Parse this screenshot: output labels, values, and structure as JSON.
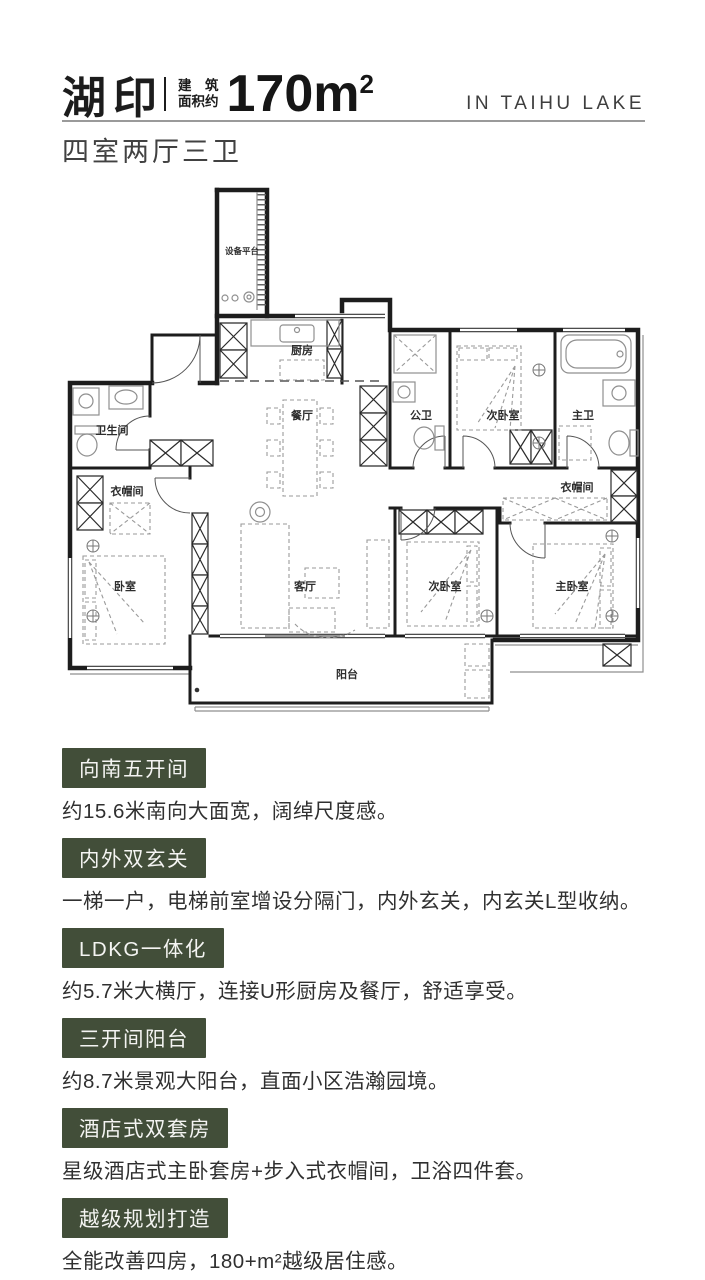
{
  "header": {
    "logo": "湖印",
    "area_label_line1": "建　筑",
    "area_label_line2": "面积约",
    "area_value": "170m",
    "area_sup": "2",
    "tagline": "IN TAIHU LAKE",
    "subtitle": "四室两厅三卫"
  },
  "floorplan": {
    "rooms": {
      "equipment_platform": "设备平台",
      "kitchen": "厨房",
      "dining": "餐厅",
      "guest_bath": "公卫",
      "bedroom2_top": "次卧室",
      "master_bath": "主卫",
      "bathroom": "卫生间",
      "cloakroom_left": "衣帽间",
      "bedroom_left": "卧室",
      "living": "客厅",
      "bedroom2_bottom": "次卧室",
      "master_bedroom": "主卧室",
      "cloakroom_right": "衣帽间",
      "balcony": "阳台"
    }
  },
  "features": [
    {
      "title": "向南五开间",
      "desc": "约15.6米南向大面宽，阔绰尺度感。"
    },
    {
      "title": "内外双玄关",
      "desc": "一梯一户，电梯前室增设分隔门，内外玄关，内玄关L型收纳。"
    },
    {
      "title": "LDKG一体化",
      "desc": "约5.7米大横厅，连接U形厨房及餐厅，舒适享受。"
    },
    {
      "title": "三开间阳台",
      "desc": "约8.7米景观大阳台，直面小区浩瀚园境。"
    },
    {
      "title": "酒店式双套房",
      "desc": "星级酒店式主卧套房+步入式衣帽间，卫浴四件套。"
    },
    {
      "title": "越级规划打造",
      "desc": "全能改善四房，180+m²越级居住感。"
    }
  ],
  "colors": {
    "accent_green": "#424e39",
    "title_text": "#1c1c1c",
    "body_text": "#303030",
    "rule_gray": "#9a9a9a"
  }
}
